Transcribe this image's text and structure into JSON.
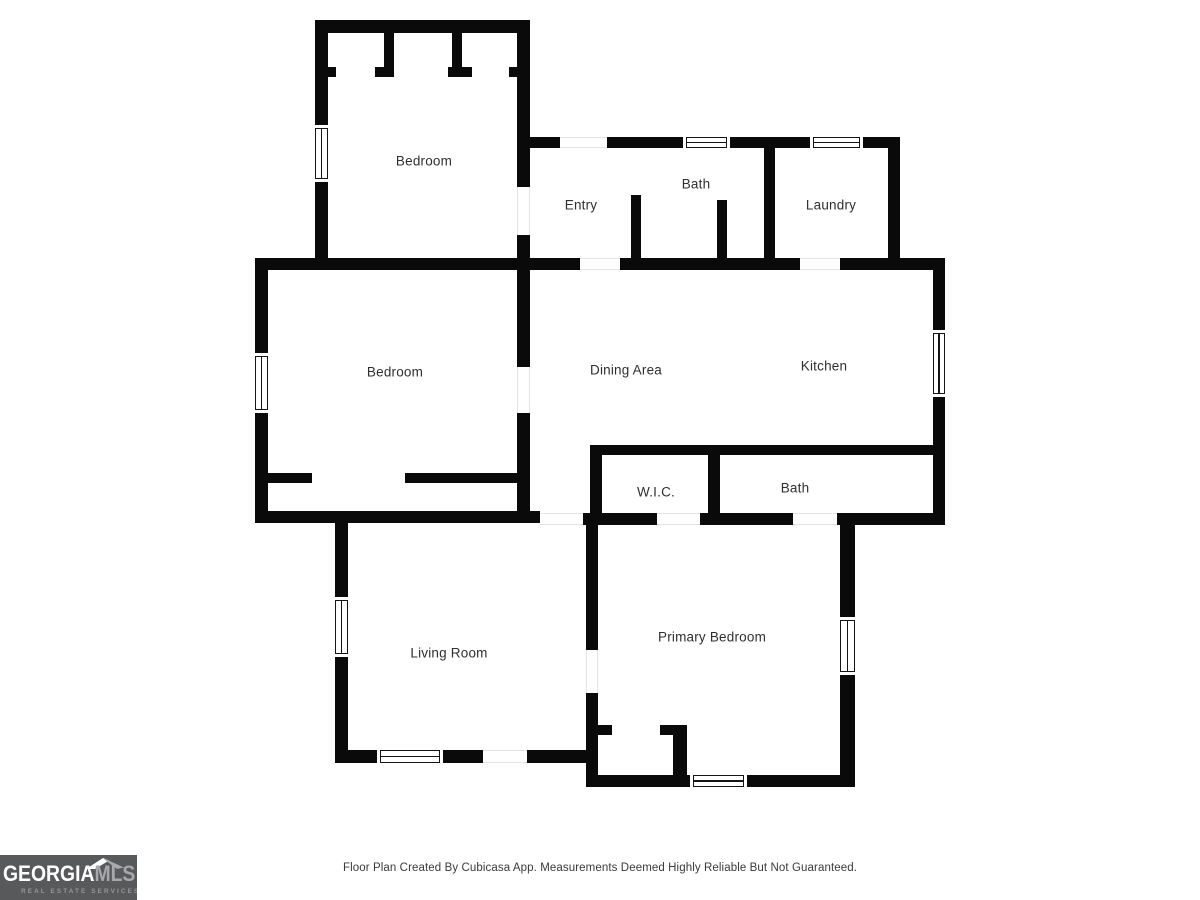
{
  "page": {
    "background": "#ffffff"
  },
  "footer": {
    "disclaimer": "Floor Plan Created By Cubicasa App. Measurements Deemed Highly Reliable But Not Guaranteed."
  },
  "logo": {
    "brand_primary": "GEORGIA",
    "brand_secondary": "MLS",
    "tagline": "REAL ESTATE SERVICES",
    "bg_color": "#58595b",
    "primary_color": "#ffffff",
    "secondary_color": "#a6a8ab",
    "tagline_color": "#95979a"
  },
  "floorplan": {
    "wall_color": "#0a0a0a",
    "rooms": [
      {
        "id": "bedroom-top",
        "label": "Bedroom",
        "cx": 424,
        "cy": 161
      },
      {
        "id": "entry",
        "label": "Entry",
        "cx": 581,
        "cy": 205
      },
      {
        "id": "bath-upper",
        "label": "Bath",
        "cx": 696,
        "cy": 184
      },
      {
        "id": "laundry",
        "label": "Laundry",
        "cx": 831,
        "cy": 205
      },
      {
        "id": "bedroom-left",
        "label": "Bedroom",
        "cx": 395,
        "cy": 372
      },
      {
        "id": "dining-area",
        "label": "Dining Area",
        "cx": 626,
        "cy": 370
      },
      {
        "id": "kitchen",
        "label": "Kitchen",
        "cx": 824,
        "cy": 366
      },
      {
        "id": "wic",
        "label": "W.I.C.",
        "cx": 656,
        "cy": 492
      },
      {
        "id": "bath-lower",
        "label": "Bath",
        "cx": 795,
        "cy": 488
      },
      {
        "id": "living-room",
        "label": "Living Room",
        "cx": 449,
        "cy": 653
      },
      {
        "id": "primary-bedroom",
        "label": "Primary Bedroom",
        "cx": 712,
        "cy": 637
      }
    ],
    "walls": [
      [
        315,
        20,
        215,
        13
      ],
      [
        315,
        20,
        13,
        105
      ],
      [
        315,
        182,
        13,
        86
      ],
      [
        517,
        20,
        13,
        167
      ],
      [
        517,
        235,
        13,
        35
      ],
      [
        384,
        33,
        10,
        44
      ],
      [
        375,
        67,
        19,
        10
      ],
      [
        452,
        33,
        10,
        44
      ],
      [
        448,
        67,
        24,
        10
      ],
      [
        328,
        67,
        8,
        10
      ],
      [
        509,
        67,
        8,
        10
      ],
      [
        530,
        137,
        30,
        11
      ],
      [
        607,
        137,
        76,
        11
      ],
      [
        730,
        137,
        80,
        11
      ],
      [
        863,
        137,
        37,
        11
      ],
      [
        888,
        137,
        12,
        121
      ],
      [
        764,
        148,
        11,
        110
      ],
      [
        631,
        195,
        10,
        63
      ],
      [
        717,
        200,
        10,
        58
      ],
      [
        255,
        258,
        325,
        12
      ],
      [
        620,
        258,
        180,
        12
      ],
      [
        840,
        258,
        105,
        12
      ],
      [
        255,
        270,
        13,
        83
      ],
      [
        255,
        413,
        13,
        110
      ],
      [
        255,
        511,
        285,
        12
      ],
      [
        517,
        270,
        13,
        97
      ],
      [
        517,
        413,
        13,
        98
      ],
      [
        268,
        473,
        44,
        10
      ],
      [
        405,
        473,
        112,
        10
      ],
      [
        933,
        270,
        12,
        60
      ],
      [
        933,
        397,
        12,
        128
      ],
      [
        590,
        445,
        355,
        10
      ],
      [
        590,
        455,
        12,
        58
      ],
      [
        708,
        455,
        12,
        58
      ],
      [
        583,
        513,
        74,
        12
      ],
      [
        700,
        513,
        93,
        12
      ],
      [
        837,
        513,
        108,
        12
      ],
      [
        335,
        523,
        13,
        74
      ],
      [
        335,
        657,
        13,
        106
      ],
      [
        335,
        750,
        42,
        13
      ],
      [
        443,
        750,
        40,
        13
      ],
      [
        527,
        750,
        65,
        13
      ],
      [
        586,
        525,
        12,
        125
      ],
      [
        586,
        693,
        12,
        94
      ],
      [
        840,
        525,
        15,
        92
      ],
      [
        840,
        675,
        15,
        112
      ],
      [
        592,
        775,
        98,
        12
      ],
      [
        747,
        775,
        108,
        12
      ],
      [
        598,
        725,
        14,
        10
      ],
      [
        660,
        725,
        27,
        10
      ],
      [
        673,
        725,
        14,
        50
      ]
    ],
    "windows": [
      [
        315,
        125,
        13,
        57,
        "v"
      ],
      [
        683,
        137,
        47,
        11,
        "h"
      ],
      [
        810,
        137,
        53,
        11,
        "h"
      ],
      [
        255,
        353,
        13,
        60,
        "v"
      ],
      [
        933,
        330,
        12,
        67,
        "v"
      ],
      [
        335,
        597,
        13,
        60,
        "v"
      ],
      [
        377,
        750,
        66,
        13,
        "h"
      ],
      [
        690,
        775,
        57,
        12,
        "h"
      ],
      [
        840,
        617,
        15,
        58,
        "v"
      ]
    ],
    "openings": [
      [
        517,
        187,
        13,
        48,
        "v"
      ],
      [
        560,
        137,
        47,
        11,
        "h"
      ],
      [
        580,
        258,
        40,
        12,
        "h"
      ],
      [
        800,
        258,
        40,
        12,
        "h"
      ],
      [
        517,
        367,
        13,
        46,
        "v"
      ],
      [
        540,
        513,
        43,
        12,
        "h"
      ],
      [
        657,
        513,
        43,
        12,
        "h"
      ],
      [
        793,
        513,
        44,
        12,
        "h"
      ],
      [
        586,
        650,
        12,
        43,
        "v"
      ],
      [
        483,
        750,
        44,
        13,
        "h"
      ]
    ]
  }
}
